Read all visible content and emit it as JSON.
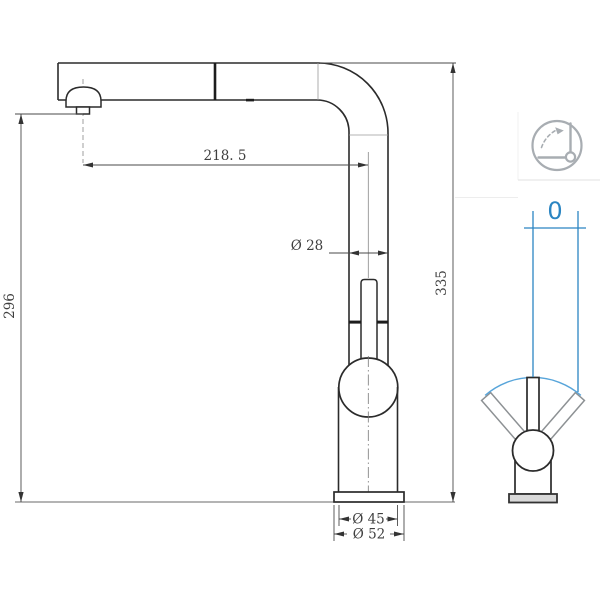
{
  "drawing": {
    "title": "faucet-technical-drawing",
    "dimensions": {
      "spout_reach": "218. 5",
      "spout_height": "296",
      "total_height": "335",
      "pipe_diameter": "Ø 28",
      "body_diameter": "Ø 45",
      "base_diameter": "Ø 52"
    },
    "swivel": {
      "angle_label": "0"
    },
    "icons": {
      "swivel_icon": "rotation-angle-icon"
    },
    "colors": {
      "line": "#2b2b2b",
      "dim_text": "#3f3f3f",
      "accent_blue": "#2b85c2",
      "arc_blue": "#58a5da",
      "icon_gray": "#a8adb2",
      "plate_fill": "#d9d9d9",
      "divider": "#e2e2e2"
    }
  }
}
